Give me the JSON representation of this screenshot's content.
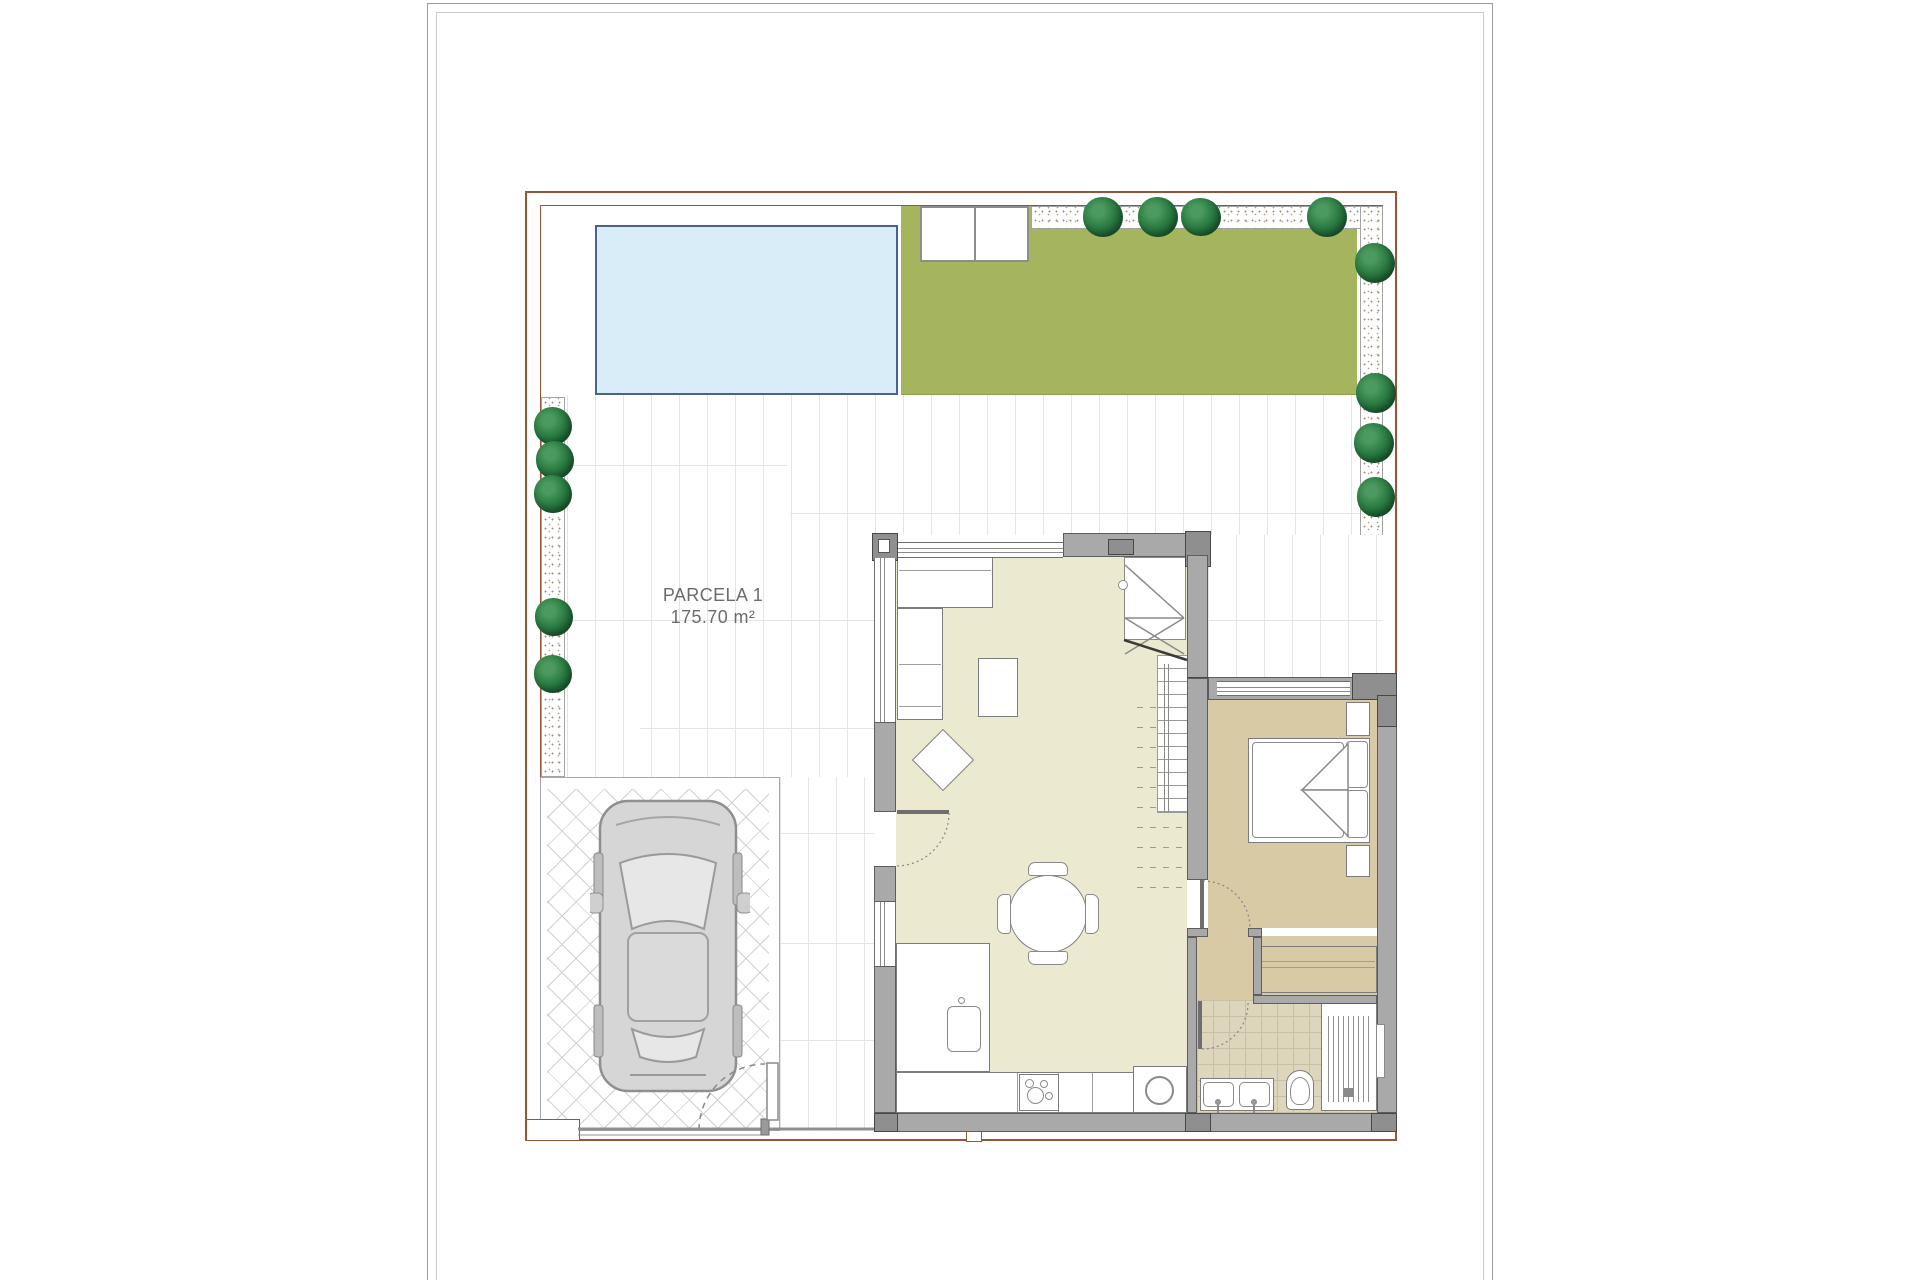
{
  "document": {
    "type": "architectural-site-plan",
    "sheet": "white drawing sheet with double border, plan of single villa plot"
  },
  "parcel": {
    "name": "PARCELA 1",
    "area": "175.70 m²"
  },
  "colors": {
    "pool_fill": "#d8edf8",
    "pool_border": "#49648c",
    "garden_lawn": "#a5b55e",
    "living_floor": "#ebead0",
    "bedroom_floor": "#d9caa6",
    "bathroom_floor": "#ded5bd",
    "wall_fill": "#a9a9a9",
    "wall_dark": "#8f8f8f",
    "plot_boundary": "#91563c",
    "bush_green": "#2c7d44",
    "car_body": "#d6d6d6",
    "label_text": "#6b6b6b"
  }
}
